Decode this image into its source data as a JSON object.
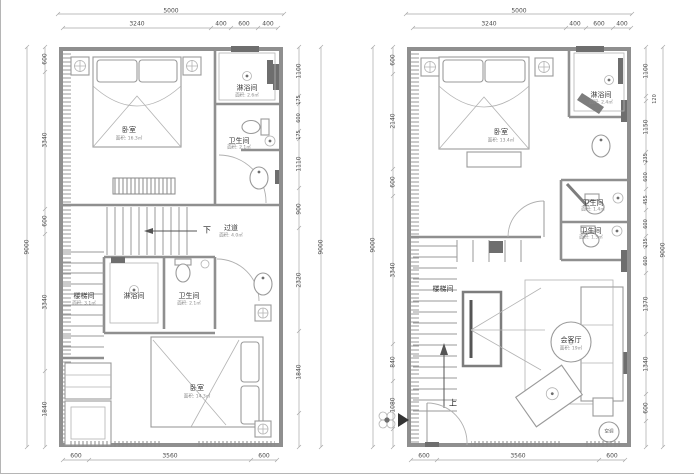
{
  "plans": {
    "left": {
      "dims": {
        "top_overall": "5000",
        "top": [
          "3240",
          "400",
          "600",
          "400"
        ],
        "left_overall": "9000",
        "left": [
          "600",
          "3340",
          "600",
          "3340",
          "1840"
        ],
        "right_overall": "9000",
        "right": [
          "1100",
          "175",
          "600",
          "175",
          "1110",
          "900",
          "2320",
          "1840"
        ],
        "bottom": [
          "600",
          "3560",
          "600"
        ]
      },
      "labels": {
        "bedroom_top": {
          "name": "卧室",
          "area": "面积: 16.3㎡"
        },
        "shower_top": {
          "name": "淋浴间",
          "area": "面积: 2.6㎡"
        },
        "bath_top": {
          "name": "卫生间",
          "area": "面积: 2.1㎡"
        },
        "down": "下",
        "corridor": {
          "name": "过道",
          "area": "面积: 4.0㎡"
        },
        "stairwell": {
          "name": "楼梯间",
          "area": "面积: 3.1㎡"
        },
        "shower_mid": {
          "name": "淋浴间"
        },
        "bath_mid": {
          "name": "卫生间",
          "area": "面积: 2.1㎡"
        },
        "bedroom_bottom": {
          "name": "卧室",
          "area": "面积: 14.3㎡"
        }
      }
    },
    "right": {
      "dims": {
        "top_overall": "5000",
        "top": [
          "3240",
          "400",
          "600",
          "400"
        ],
        "left_overall": "9000",
        "left": [
          "600",
          "2140",
          "600",
          "3340",
          "840",
          "1080"
        ],
        "right_overall": "9000",
        "right": [
          "1100",
          "120",
          "1150",
          "235",
          "600",
          "455",
          "600",
          "235",
          "600",
          "1370",
          "1340",
          "600"
        ],
        "bottom": [
          "600",
          "3560",
          "600"
        ]
      },
      "labels": {
        "bedroom": {
          "name": "卧室",
          "area": "面积: 13.4㎡"
        },
        "shower": {
          "name": "淋浴间",
          "area": "面积: 2.4㎡"
        },
        "bath_upper": {
          "name": "卫生间",
          "area": "面积: 1.4㎡"
        },
        "bath_lower": {
          "name": "卫生间",
          "area": "面积: 1.5㎡"
        },
        "stairwell": {
          "name": "楼梯间"
        },
        "living": {
          "name": "会客厅",
          "area": "面积: 19㎡"
        },
        "up": "上",
        "ac": "空调"
      }
    }
  },
  "colors": {
    "wall": "#8f8f8f",
    "dim_text": "#4a4a4a",
    "accent_dark": "#6e6e6e"
  }
}
